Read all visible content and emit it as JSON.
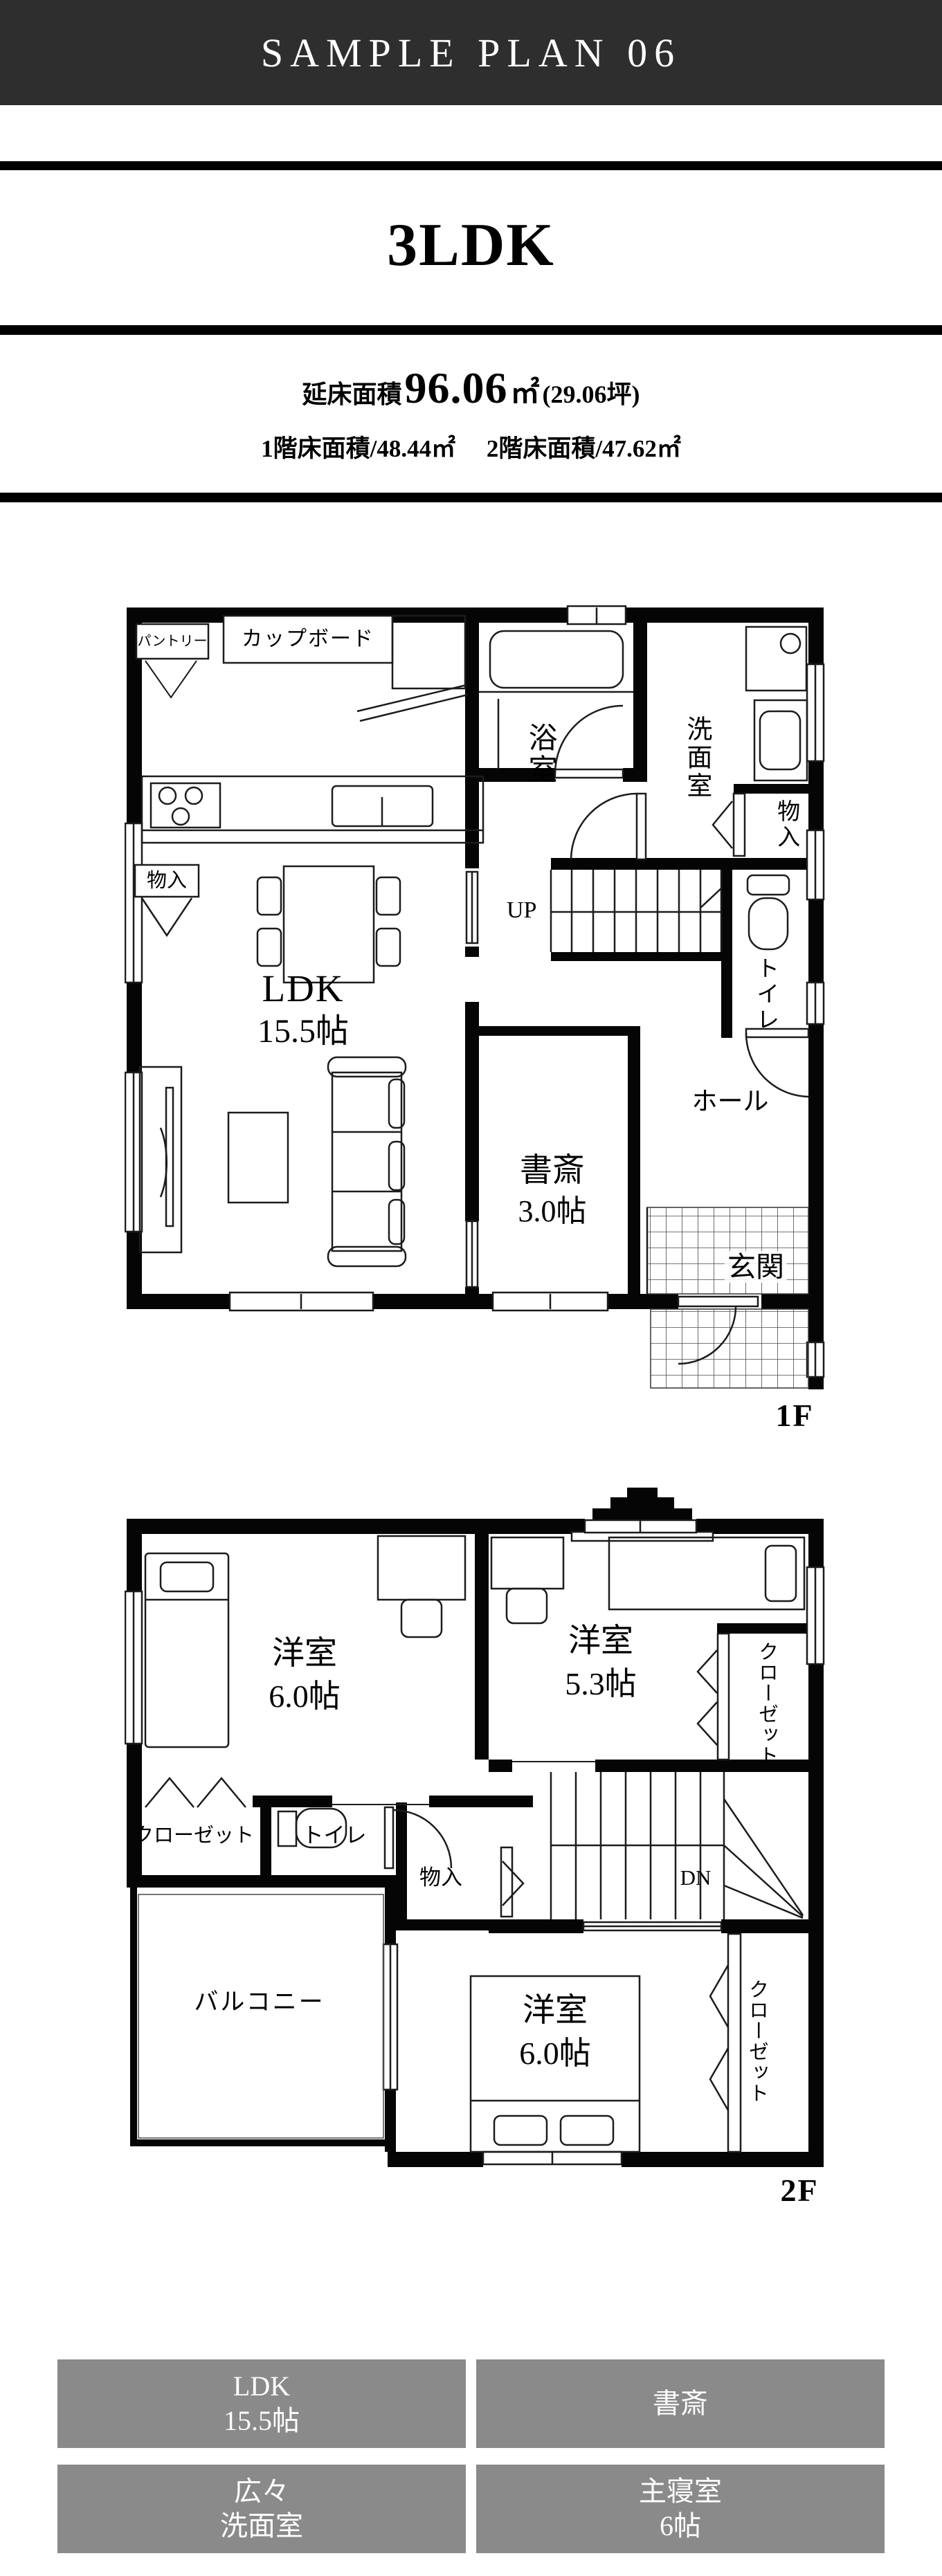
{
  "header": {
    "title": "SAMPLE PLAN 06"
  },
  "plan_title": "3LDK",
  "area": {
    "total_label": "延床面積",
    "total_value": "96.06",
    "total_unit": "㎡",
    "total_tsubo": "(29.06坪)",
    "floor1": "1階床面積/48.44㎡",
    "floor2": "2階床面積/47.62㎡"
  },
  "floor1": {
    "tag": "1F",
    "labels": {
      "pantry": "パントリー",
      "cupboard": "カップボード",
      "bath": "浴室",
      "washroom": "洗面室",
      "storage_right": "物入",
      "storage_left": "物入",
      "stairs": "UP",
      "toilet": "トイレ",
      "hall": "ホール",
      "study1": "書斎",
      "study2": "3.0帖",
      "entrance": "玄関",
      "ldk1": "LDK",
      "ldk2": "15.5帖"
    }
  },
  "floor2": {
    "tag": "2F",
    "labels": {
      "bedroom_a1": "洋室",
      "bedroom_a2": "6.0帖",
      "bedroom_b1": "洋室",
      "bedroom_b2": "5.3帖",
      "closet_mid": "クローゼット",
      "closet_left": "クローゼット",
      "closet_main": "クローゼット",
      "toilet": "トイレ",
      "storage": "物入",
      "stairs": "DN",
      "balcony": "バルコニー",
      "bedroom_c1": "洋室",
      "bedroom_c2": "6.0帖"
    }
  },
  "legend": {
    "items": [
      {
        "line1": "LDK",
        "line2": "15.5帖"
      },
      {
        "line1": "書斎",
        "line2": ""
      },
      {
        "line1": "広々",
        "line2": "洗面室"
      },
      {
        "line1": "主寝室",
        "line2": "6帖"
      }
    ]
  },
  "colors": {
    "header_bg": "#2e2e2e",
    "legend_bg": "#8a8a8a",
    "ink": "#000000"
  }
}
